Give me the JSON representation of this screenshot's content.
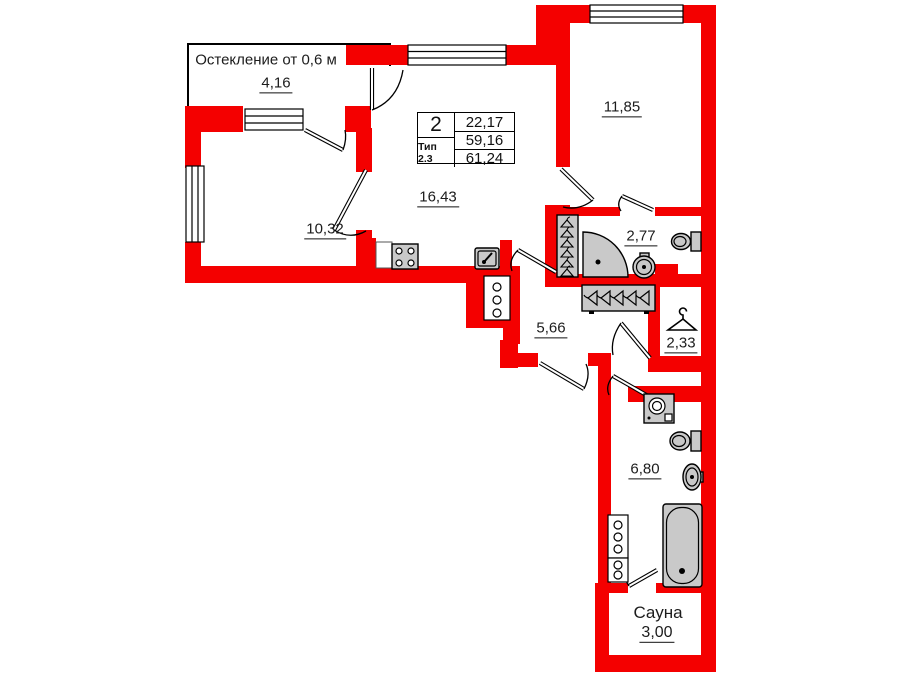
{
  "colors": {
    "wall": "#f40000",
    "fixture": "#c9c9c9",
    "line": "#000000",
    "bg": "#ffffff"
  },
  "balcony": {
    "note": "Остекление от 0,6 м",
    "area": "4,16"
  },
  "info_box": {
    "rooms_count": "2",
    "type": "Тип 2.3",
    "living_area": "22,17",
    "area": "59,16",
    "total_area": "61,24"
  },
  "rooms": {
    "bedroom_left": {
      "area": "10,32"
    },
    "living_kitchen": {
      "area": "16,43"
    },
    "bedroom_top": {
      "area": "11,85"
    },
    "bathroom_ensuite": {
      "area": "2,77"
    },
    "hallway": {
      "area": "5,66"
    },
    "wardrobe": {
      "area": "2,33"
    },
    "bathroom_main": {
      "area": "6,80"
    },
    "sauna": {
      "name": "Сауна",
      "area": "3,00"
    }
  },
  "icons": {
    "stove": "stove-icon",
    "kitchen_sink": "sink-icon",
    "corner_shower": "corner-shower-icon",
    "toilet": "toilet-icon",
    "washbasin": "washbasin-icon",
    "washing_machine": "washing-machine-icon",
    "bathtub": "bathtub-icon",
    "clothes_hanger": "clothes-hanger-icon",
    "wardrobe_hangers": "wardrobe-hangers-icon",
    "utility_riser": "utility-riser-icon"
  }
}
